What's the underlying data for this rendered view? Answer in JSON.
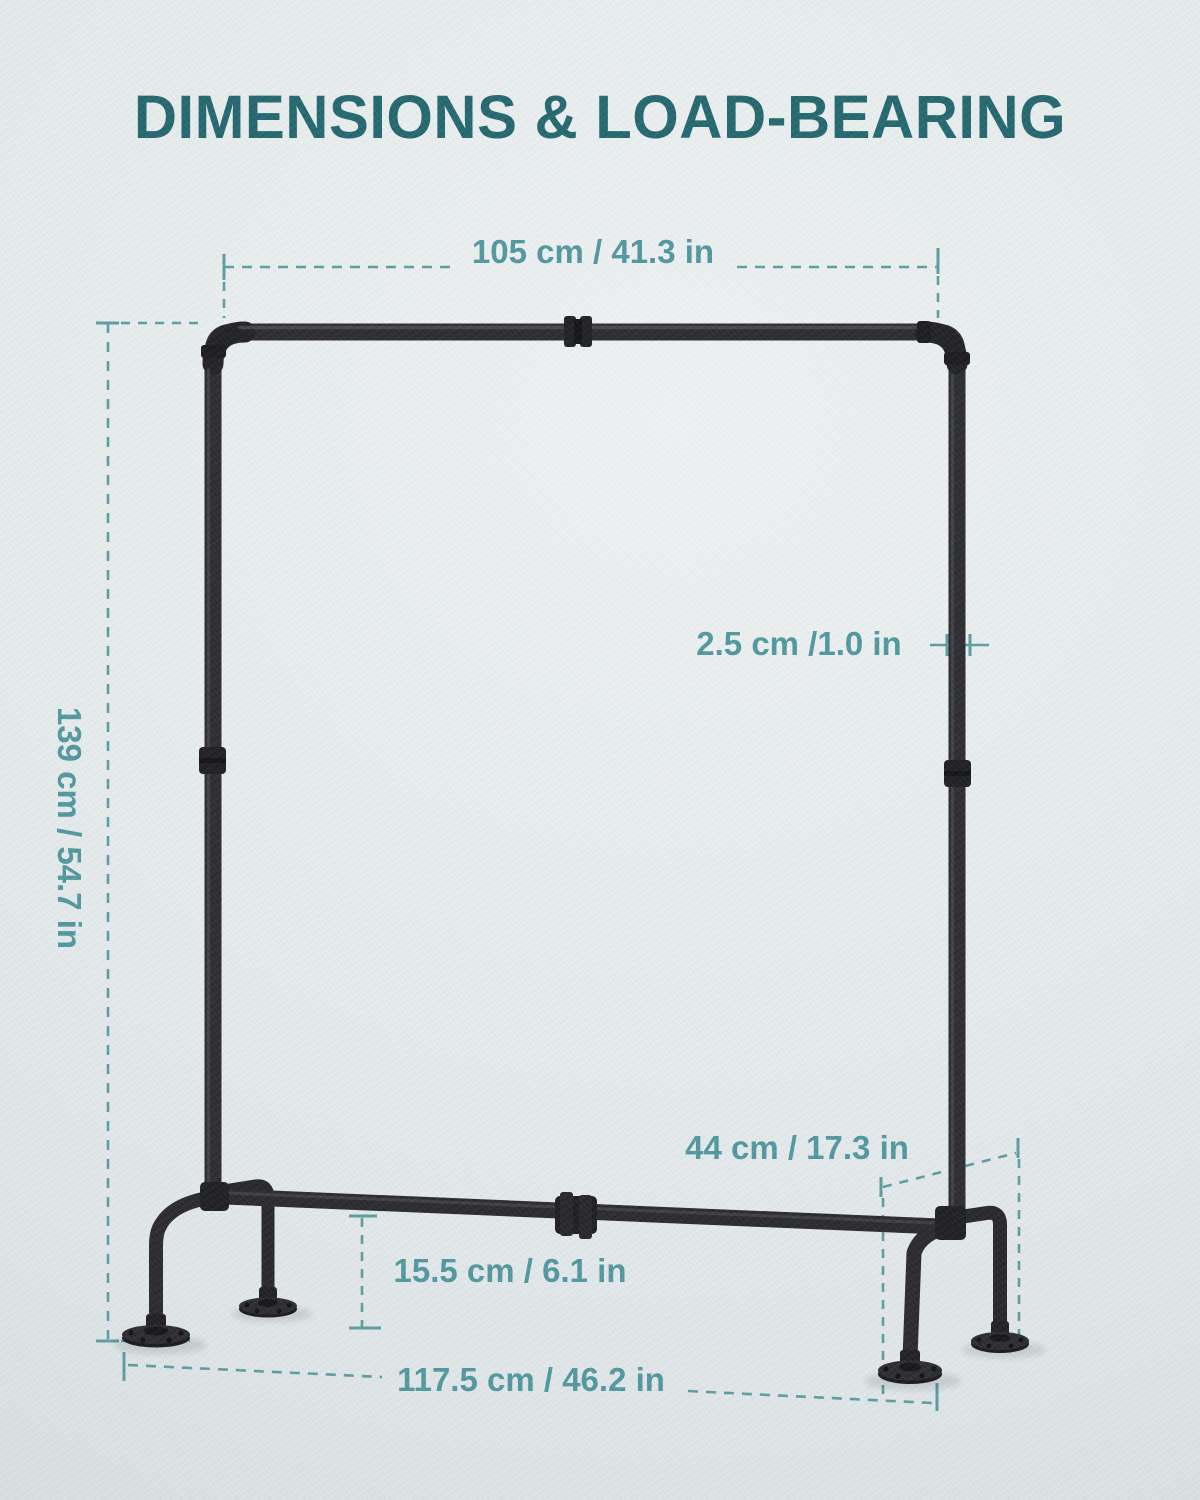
{
  "title": {
    "text": "DIMENSIONS & LOAD-BEARING"
  },
  "illustration": "industrial-pipe-clothing-rack",
  "colors": {
    "background": "#e4e9ea",
    "title_text": "#20646c",
    "dimension_text": "#4e969c",
    "dimension_lines": "#589ba0",
    "pipe": "#28282c",
    "pipe_fittings": "#1b1b1e"
  },
  "dimensions": {
    "top_width": "105 cm / 41.3 in",
    "height": "139 cm / 54.7 in",
    "pipe_diameter": "2.5 cm /1.0 in",
    "depth": "44 cm / 17.3 in",
    "bottom_bar_height": "15.5 cm / 6.1 in",
    "base_width": "117.5 cm / 46.2 in"
  }
}
